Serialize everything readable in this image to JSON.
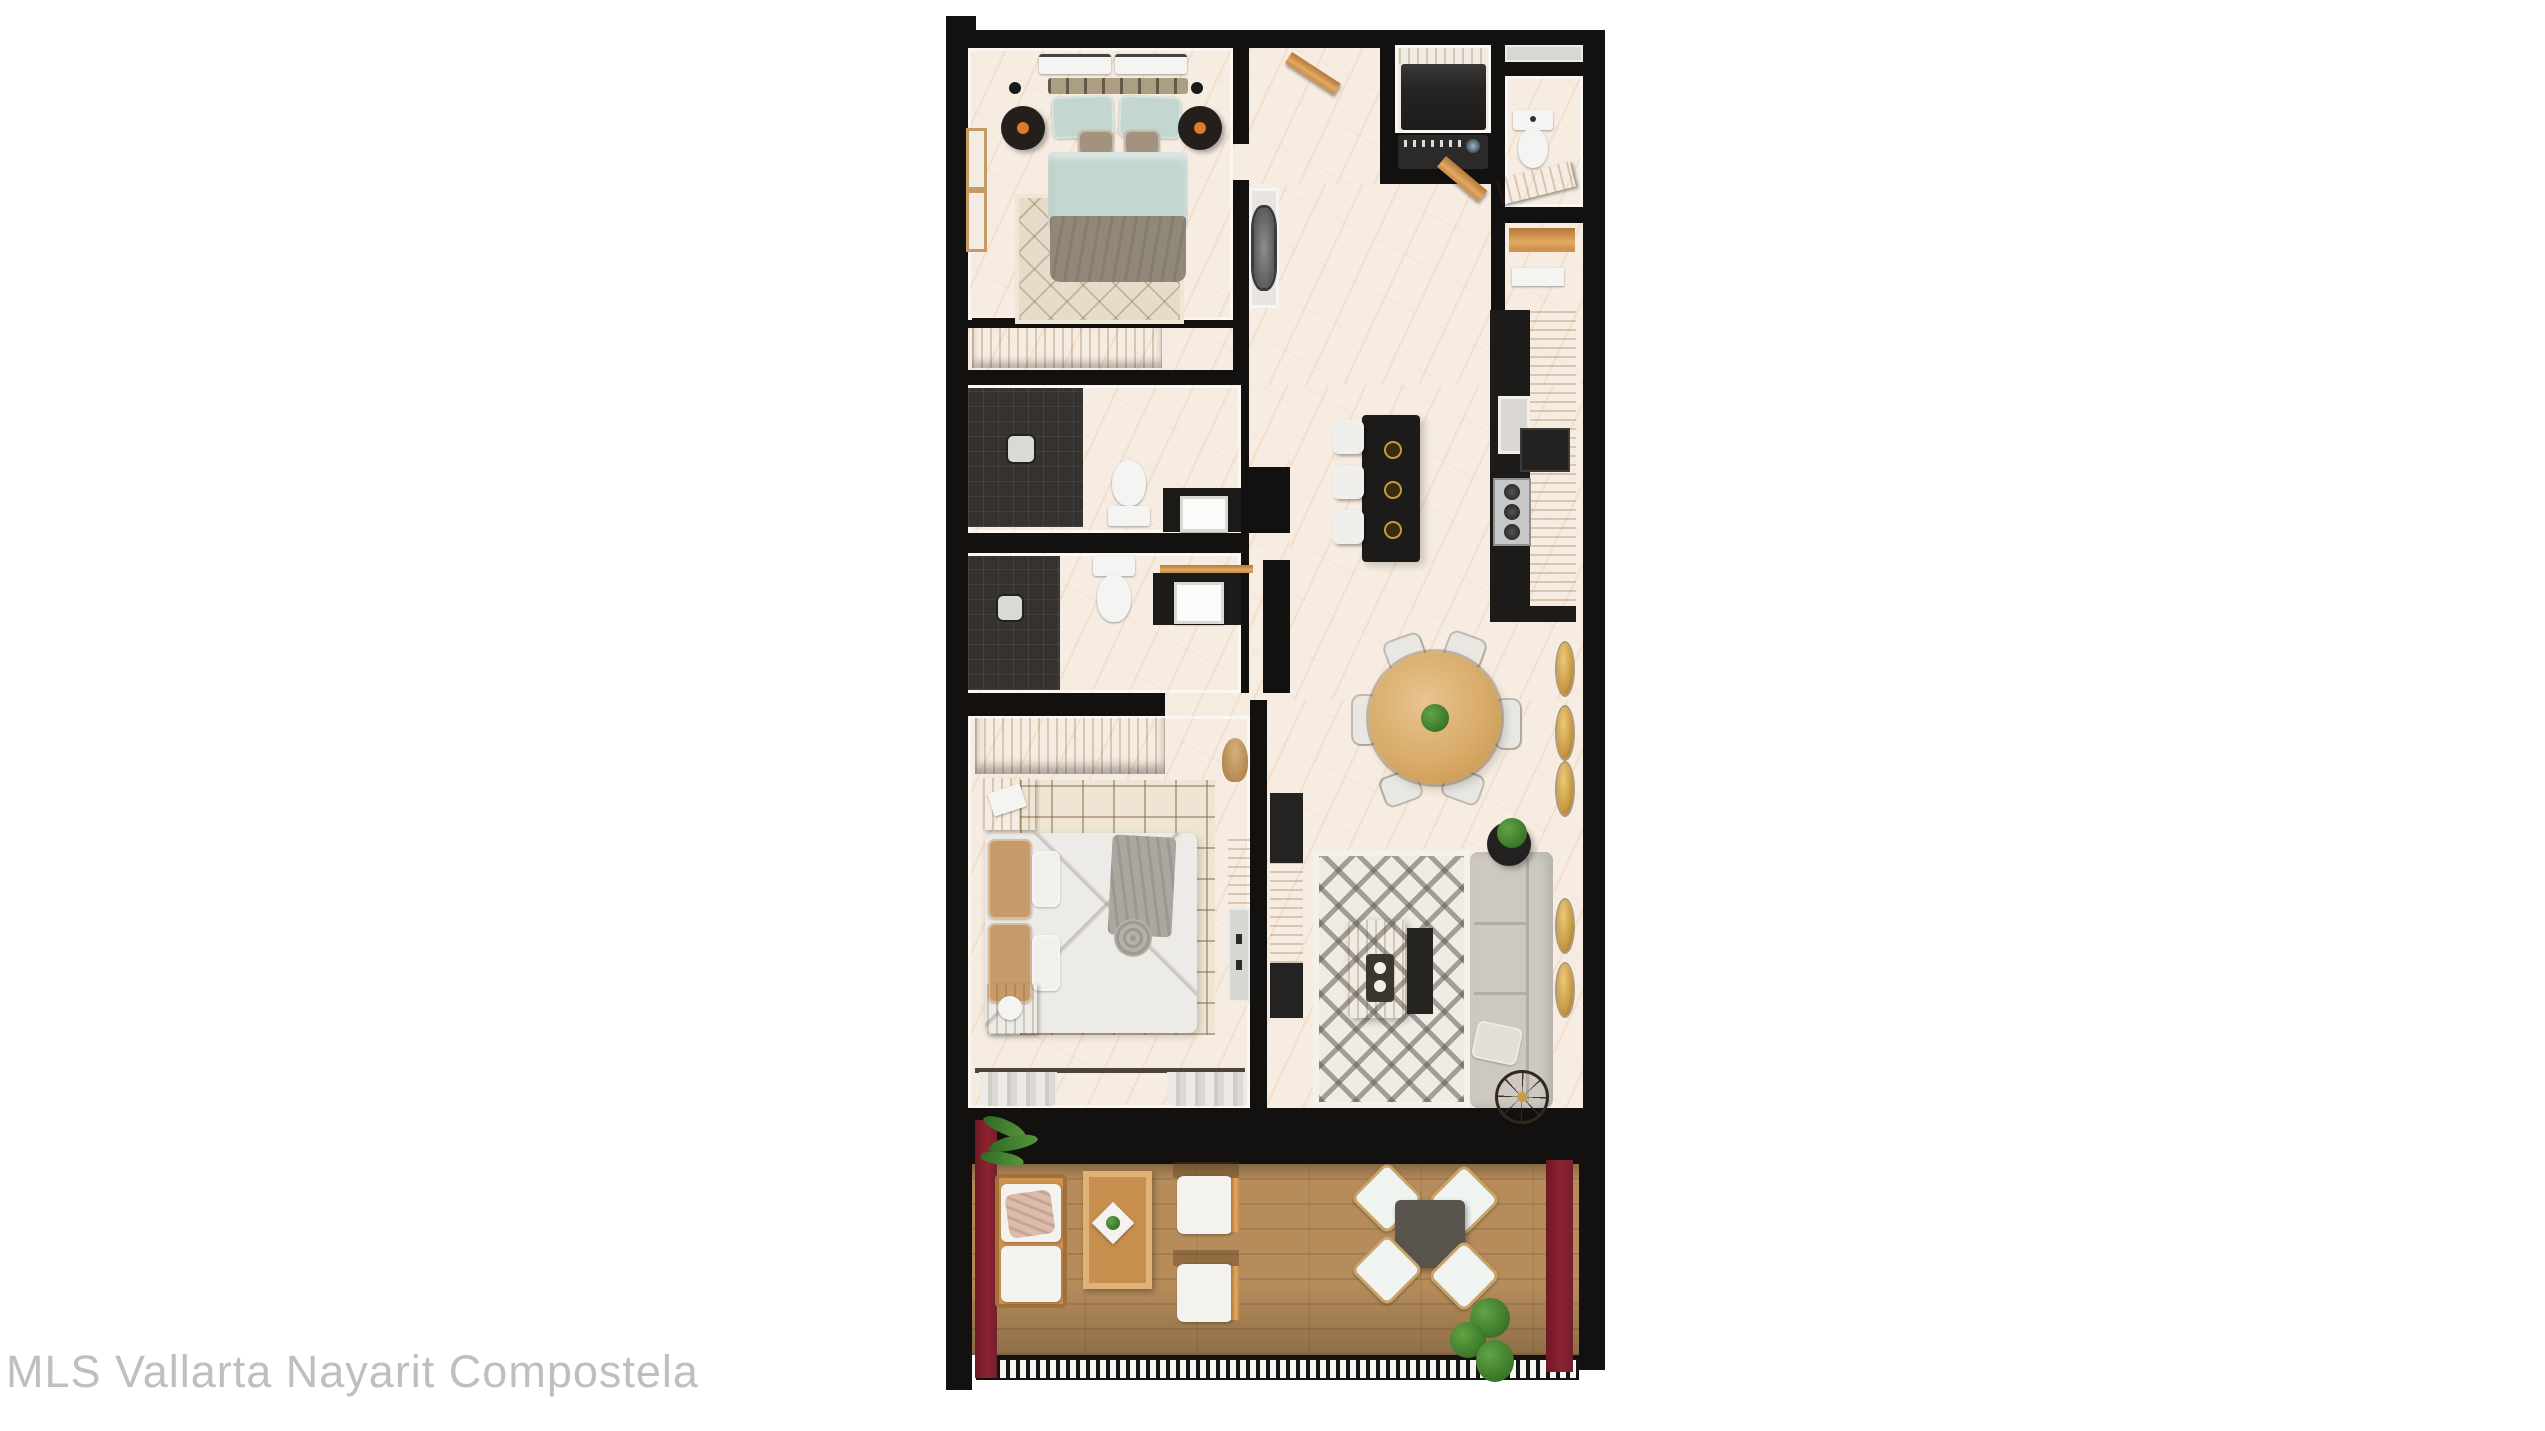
{
  "watermark": {
    "text": "MLS Vallarta Nayarit Compostela"
  },
  "palette": {
    "page-bg": "#ffffff",
    "wall": "#121110",
    "marble": "#f6ece1",
    "wood": "#cf9350",
    "wood-dark": "#b27a3e",
    "wood-light": "#e2ab63",
    "counter": "#1c1b19",
    "shower": "#35322f",
    "white-fixture": "#f4f4f2",
    "teal": "#c3d6cf",
    "taupe": "#a2927e",
    "blanket": "#91887a",
    "rug-beige": "#e7dbc9",
    "check-rug": "#efe5d4",
    "living-rug": "#f0ece4",
    "sofa": "#cdc9c2",
    "sofa-line": "#b1ada6",
    "deck": "#b68c5b",
    "red-wall": "#8c2330",
    "gold": "#c99b43",
    "green": "#3f7d2c",
    "green-dark": "#2c5e1e",
    "stool-white": "#f1efec",
    "steel": "#c7c7c7",
    "watermark": "#bfbfbf"
  }
}
